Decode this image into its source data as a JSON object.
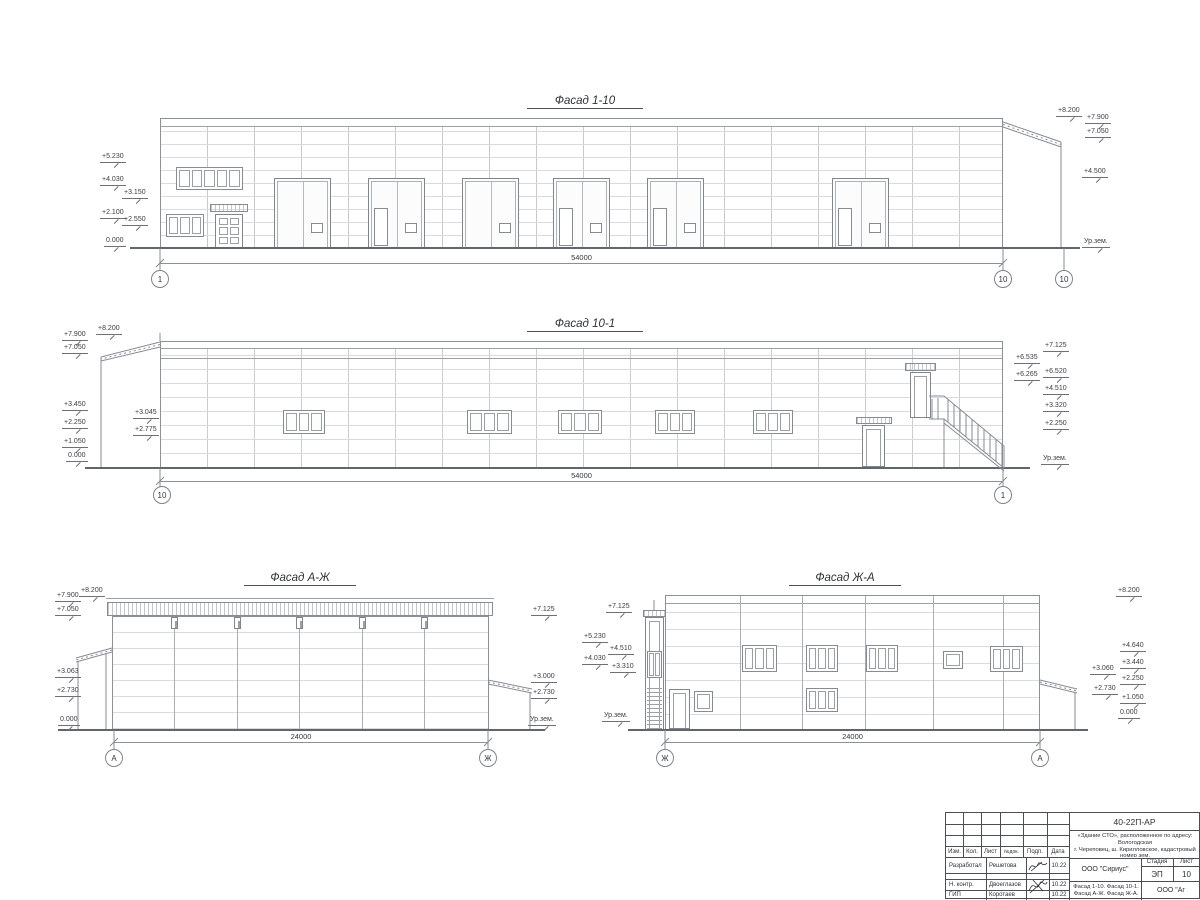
{
  "sheet": {
    "background": "#ffffff",
    "line_color": "#8b9199",
    "ground_color": "#61666d"
  },
  "facades": [
    {
      "title": "Фасад 1-10",
      "dimension": "54000",
      "axes": [
        {
          "t": "1",
          "x": 160,
          "y": 279
        },
        {
          "t": "10",
          "x": 1003,
          "y": 279
        },
        {
          "t": "10",
          "x": 1064,
          "y": 279
        }
      ],
      "markers": [
        {
          "t": "+5.230",
          "x": 100,
          "y": 153
        },
        {
          "t": "+4.030",
          "x": 100,
          "y": 176
        },
        {
          "t": "+3.150",
          "x": 122,
          "y": 189
        },
        {
          "t": "+2.100",
          "x": 100,
          "y": 209
        },
        {
          "t": "+2.550",
          "x": 122,
          "y": 216
        },
        {
          "t": "0.000",
          "x": 104,
          "y": 237
        },
        {
          "t": "+8.200",
          "x": 1056,
          "y": 107
        },
        {
          "t": "+7.900",
          "x": 1085,
          "y": 114
        },
        {
          "t": "+7.050",
          "x": 1085,
          "y": 128
        },
        {
          "t": "+4.500",
          "x": 1082,
          "y": 168
        },
        {
          "t": "Ур.зем.",
          "x": 1082,
          "y": 238
        }
      ]
    },
    {
      "title": "Фасад 10-1",
      "dimension": "54000",
      "axes": [
        {
          "t": "10",
          "x": 162,
          "y": 495
        },
        {
          "t": "1",
          "x": 1003,
          "y": 495
        }
      ],
      "markers": [
        {
          "t": "+8.200",
          "x": 96,
          "y": 325
        },
        {
          "t": "+7.900",
          "x": 62,
          "y": 331
        },
        {
          "t": "+7.050",
          "x": 62,
          "y": 344
        },
        {
          "t": "+3.450",
          "x": 62,
          "y": 401
        },
        {
          "t": "+3.045",
          "x": 133,
          "y": 409
        },
        {
          "t": "+2.250",
          "x": 62,
          "y": 419
        },
        {
          "t": "+2.775",
          "x": 133,
          "y": 426
        },
        {
          "t": "+1.050",
          "x": 62,
          "y": 438
        },
        {
          "t": "0.000",
          "x": 66,
          "y": 452
        },
        {
          "t": "+7.125",
          "x": 1043,
          "y": 342
        },
        {
          "t": "+6.535",
          "x": 1014,
          "y": 354
        },
        {
          "t": "+6.520",
          "x": 1043,
          "y": 368
        },
        {
          "t": "+6.265",
          "x": 1014,
          "y": 371
        },
        {
          "t": "+4.510",
          "x": 1043,
          "y": 385
        },
        {
          "t": "+3.320",
          "x": 1043,
          "y": 402
        },
        {
          "t": "+2.250",
          "x": 1043,
          "y": 420
        },
        {
          "t": "Ур.зем.",
          "x": 1041,
          "y": 455
        }
      ]
    },
    {
      "title": "Фасад А-Ж",
      "dimension": "24000",
      "axes": [
        {
          "t": "А",
          "x": 114,
          "y": 758
        },
        {
          "t": "Ж",
          "x": 488,
          "y": 758
        }
      ],
      "markers": [
        {
          "t": "+7.900",
          "x": 55,
          "y": 592
        },
        {
          "t": "+8.200",
          "x": 79,
          "y": 587
        },
        {
          "t": "+7.050",
          "x": 55,
          "y": 606
        },
        {
          "t": "+3.063",
          "x": 55,
          "y": 668
        },
        {
          "t": "+2.730",
          "x": 55,
          "y": 687
        },
        {
          "t": "0.000",
          "x": 58,
          "y": 716
        },
        {
          "t": "+7.125",
          "x": 531,
          "y": 606
        },
        {
          "t": "+3.000",
          "x": 531,
          "y": 673
        },
        {
          "t": "+2.730",
          "x": 531,
          "y": 689
        },
        {
          "t": "Ур.зем.",
          "x": 528,
          "y": 716
        }
      ]
    },
    {
      "title": "Фасад Ж-А",
      "dimension": "24000",
      "axes": [
        {
          "t": "Ж",
          "x": 665,
          "y": 758
        },
        {
          "t": "А",
          "x": 1040,
          "y": 758
        }
      ],
      "markers": [
        {
          "t": "+7.125",
          "x": 606,
          "y": 603
        },
        {
          "t": "+5.230",
          "x": 582,
          "y": 633
        },
        {
          "t": "+4.510",
          "x": 608,
          "y": 645
        },
        {
          "t": "+4.030",
          "x": 582,
          "y": 655
        },
        {
          "t": "+3.310",
          "x": 610,
          "y": 663
        },
        {
          "t": "Ур.зем.",
          "x": 602,
          "y": 712
        },
        {
          "t": "+8.200",
          "x": 1116,
          "y": 587
        },
        {
          "t": "+4.640",
          "x": 1120,
          "y": 642
        },
        {
          "t": "+3.440",
          "x": 1120,
          "y": 659
        },
        {
          "t": "+3.060",
          "x": 1090,
          "y": 665
        },
        {
          "t": "+2.250",
          "x": 1120,
          "y": 675
        },
        {
          "t": "+2.730",
          "x": 1092,
          "y": 685
        },
        {
          "t": "+1.050",
          "x": 1120,
          "y": 694
        },
        {
          "t": "0.000",
          "x": 1118,
          "y": 709
        }
      ]
    }
  ],
  "titleblock": {
    "doc_number": "40-22П-АР",
    "project_line1": "«Здание СТО», расположенное по адресу: Вологодская",
    "project_line2": "г. Череповец, ш. Кирилловское, кадастровый номер зем.",
    "project_line3": "участка: 35:21.0304001:67",
    "cols": [
      "Изм.",
      "Кол.",
      "Лист",
      "№док.",
      "Подп.",
      "Дата"
    ],
    "rows": [
      {
        "role": "Разработал",
        "name": "Решетова",
        "date": "10.22"
      },
      {
        "role": "Н. контр.",
        "name": "Двоеглазов",
        "date": "10.22"
      },
      {
        "role": "ГИП",
        "name": "Коротаев",
        "date": "10.22"
      }
    ],
    "company": "ООО \"Сириус\"",
    "stage_label": "Стадия",
    "sheet_label": "Лист",
    "stage_value": "ЭП",
    "sheet_value": "10",
    "content_line1": "Фасад 1-10. Фасад 10-1.",
    "content_line2": "Фасад А-Ж. Фасад Ж-А.",
    "company2": "ООО \"Аг"
  }
}
